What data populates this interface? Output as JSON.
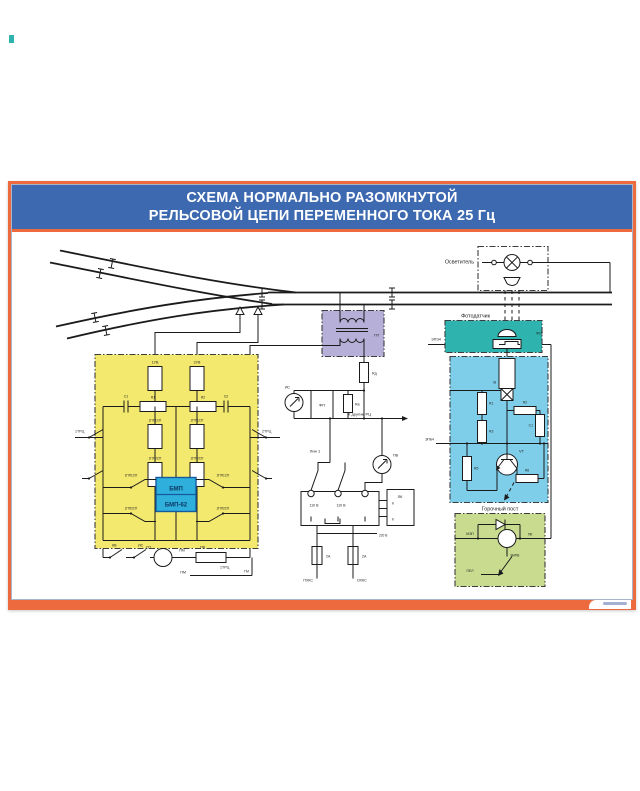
{
  "title": {
    "line1": "СХЕМА НОРМАЛЬНО РАЗОМКНУТОЙ",
    "line2": "РЕЛЬСОВОЙ ЦЕПИ ПЕРЕМЕННОГО ТОКА 25 Гц"
  },
  "colors": {
    "frame_orange": "#ec6a3e",
    "title_blue": "#3d69b1",
    "block_yellow": "#f4e96f",
    "block_purple": "#b6afd8",
    "block_teal": "#2eb3ae",
    "block_blue": "#7ecde9",
    "block_green": "#c8db8f",
    "bmp_cyan": "#2fafdc"
  },
  "sections": {
    "illuminator": "Осветитель",
    "photosensor": "Фотодатчик",
    "hump_post": "Горочный пост",
    "to_other_circuits": "К другим РЦ",
    "line1_group": "Лин 1"
  },
  "relay_block": {
    "bmp": "БМП",
    "bmp62": "БМП-62"
  },
  "labels": {
    "uv1": "1УВ",
    "uv2": "2УВ",
    "c1": "С1",
    "r1": "R1",
    "r2": "R2",
    "c2": "С2",
    "pp1sp_1": "1ПП1СП",
    "pp1sp_2": "2ПП1СП",
    "pp2sp_1": "1ПП2СП",
    "pp2sp_2": "2ПП2СП",
    "trc1": "1ТРЦ",
    "trc2": "2ТРЦ",
    "kv": "КВ",
    "is": "ИС",
    "sp": "СП",
    "pm": "ПМ",
    "gm": "ГМ",
    "pv": "ПВ",
    "pt": "ПТ",
    "rd": "Rд",
    "fp": "ФП",
    "rv": "Rв",
    "v110": "110 В",
    "v220": "220 В",
    "lk": "ЛК",
    "k": "К",
    "a2": "2А",
    "phks": "ПХКС",
    "ohks": "ОХКС",
    "fsk": "ФСК",
    "epe4": "ЭПЭ4",
    "epb4": "ЭПБ4",
    "mep": "МЭП",
    "v": "В",
    "br1": "R1",
    "br2": "R2",
    "br3": "R3",
    "bc1": "С1",
    "br5": "R5",
    "br6": "R6",
    "vt": "VT",
    "pk": "ПК",
    "empv": "ЭМПВ",
    "pel": "ПЕЛ"
  }
}
